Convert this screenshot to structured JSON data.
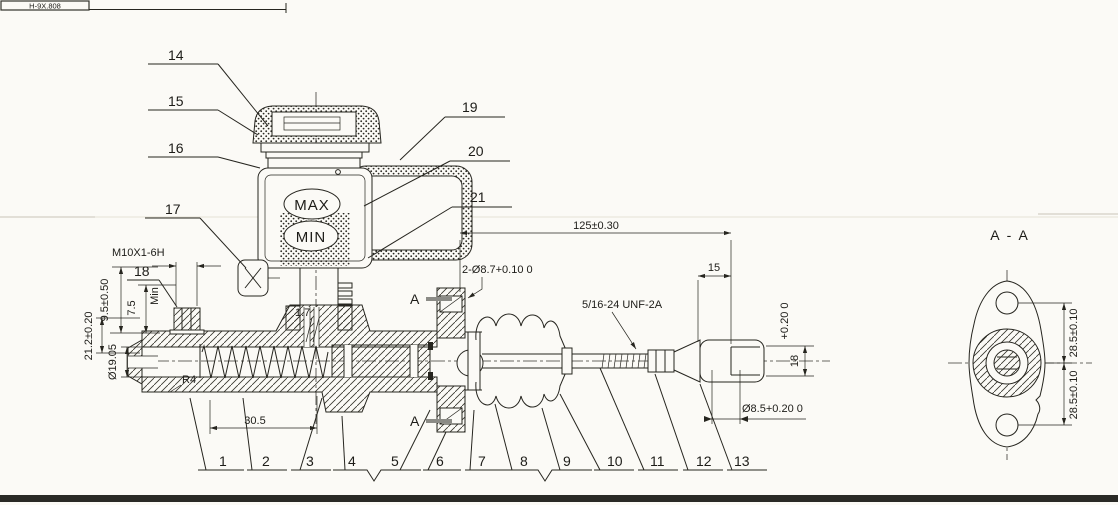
{
  "page": {
    "title_block_fragment": "H-9X.808",
    "background": "#fbfaf6",
    "line_color": "#26251f"
  },
  "labels": {
    "max": "MAX",
    "min": "MIN",
    "section_title": "A - A",
    "section_marker": "A"
  },
  "parts": {
    "1": "1",
    "2": "2",
    "3": "3",
    "4": "4",
    "5": "5",
    "6": "6",
    "7": "7",
    "8": "8",
    "9": "9",
    "10": "10",
    "11": "11",
    "12": "12",
    "13": "13",
    "14": "14",
    "15": "15",
    "16": "16",
    "17": "17",
    "18": "18",
    "19": "19",
    "20": "20",
    "21": "21"
  },
  "dimensions": {
    "thread_left": "M10X1-6H",
    "d95": "9.5±0.50",
    "d75": "7.5",
    "min_note": "Min",
    "d212": "21.2±0.20",
    "d1905": "Ø19.05",
    "r4": "R4",
    "d305": "30.5",
    "d17": "1.7",
    "d125": "125±0.30",
    "holes": "2-Ø8.7+0.10  0",
    "d15": "15",
    "thread_rod": "5/16-24 UNF-2A",
    "tol18": "+0.20  0",
    "d18": "18",
    "d85": "Ø8.5+0.20  0",
    "d285": "28.5±0.10"
  }
}
